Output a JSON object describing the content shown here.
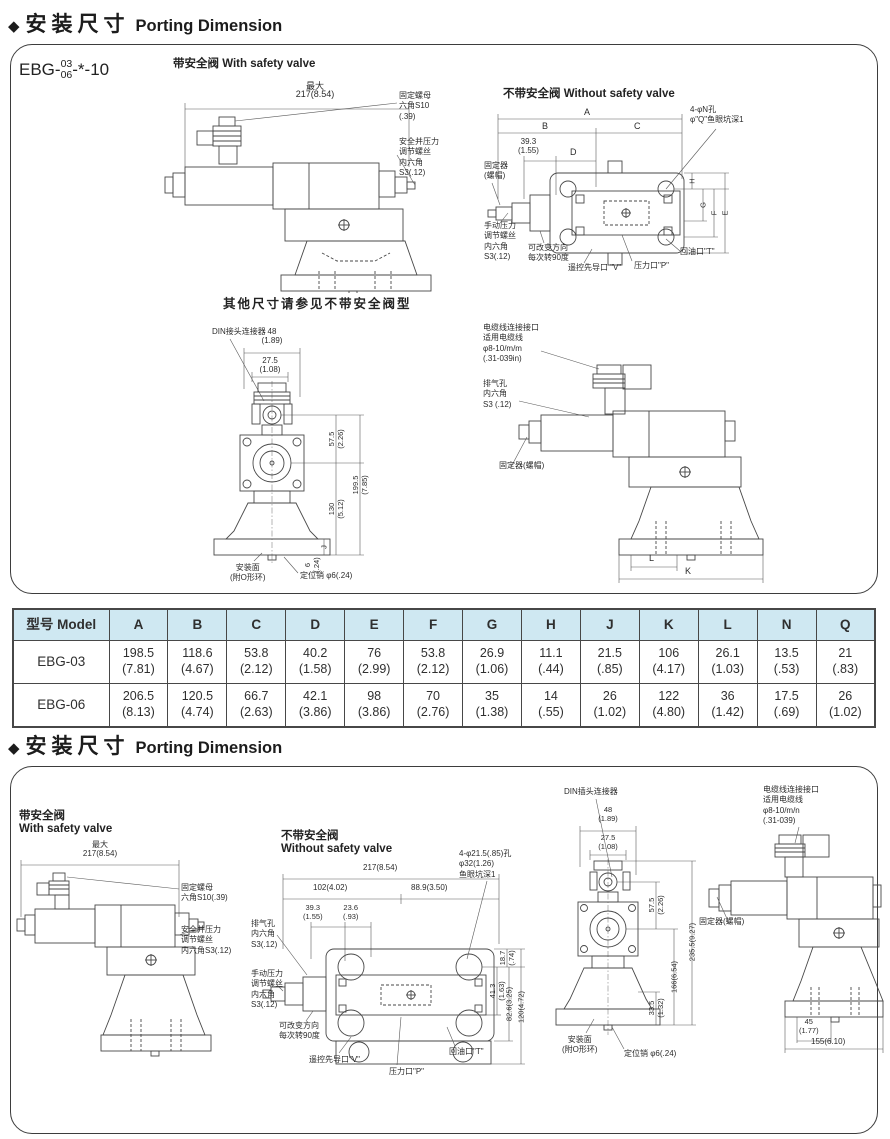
{
  "header1": {
    "diamond": "◆",
    "zh": "安装尺寸",
    "en": "Porting Dimension"
  },
  "header2": {
    "diamond": "◆",
    "zh": "安装尺寸",
    "en": "Porting Dimension"
  },
  "model": {
    "prefix": "EBG-",
    "top": "03",
    "bottom": "06",
    "suffix": "-*-10"
  },
  "p1": {
    "d1": {
      "title": "带安全阀   With safety valve",
      "dim_max": "最大",
      "dim_217": "217(8.54)",
      "lbl_nut": "固定螺母\n六角S10\n(.39)",
      "lbl_adj": "安全并压力\n调节螺丝\n内六角\nS3(.12)",
      "caption": "其他尺寸请参见不带安全阀型"
    },
    "d2": {
      "title": "不带安全阀   Without safety valve",
      "A": "A",
      "B": "B",
      "C": "C",
      "D": "D",
      "d393": "39.3\n(1.55)",
      "E": "E",
      "F": "F",
      "G": "G",
      "H": "H",
      "lbl_holes": "4-φN孔\nφ\"Q\"鱼眼坑深1",
      "lbl_fixer": "固定器\n(螺帽)",
      "lbl_manual": "手动压力\n调节螺丝\n内六角\nS3(.12)",
      "lbl_rotate": "可改变方向\n每次转90度",
      "lbl_pilot": "遥控先导口 \"V\"",
      "lbl_pressure": "压力口\"P\"",
      "lbl_return": "回油口\"T\""
    },
    "d3": {
      "lbl_din": "DIN接头连接器",
      "dim48": "48\n(1.89)",
      "dim275": "27.5\n(1.08)",
      "dim575": "57.5\n(2.26)",
      "dim1995": "199.5\n(7.85)",
      "dim130": "130\n(5.12)",
      "dimJ": "J",
      "dim6": "6\n(.24)",
      "lbl_mount": "安装面\n(附O形环)",
      "lbl_pin": "定位销 φ6(.24)"
    },
    "d4": {
      "lbl_cable": "电缆线连接接口\n适用电缆线\nφ8-10/m/m\n(.31-039in)",
      "lbl_vent": "排气孔\n内六角\nS3 (.12)",
      "lbl_fixer": "固定器(螺帽)",
      "dimL": "L",
      "dimK": "K"
    }
  },
  "table": {
    "headers": [
      "型号 Model",
      "A",
      "B",
      "C",
      "D",
      "E",
      "F",
      "G",
      "H",
      "J",
      "K",
      "L",
      "N",
      "Q"
    ],
    "rows": [
      {
        "model": "EBG-03",
        "cells": [
          "198.5\n(7.81)",
          "118.6\n(4.67)",
          "53.8\n(2.12)",
          "40.2\n(1.58)",
          "76\n(2.99)",
          "53.8\n(2.12)",
          "26.9\n(1.06)",
          "11.1\n(.44)",
          "21.5\n(.85)",
          "106\n(4.17)",
          "26.1\n(1.03)",
          "13.5\n(.53)",
          "21\n(.83)"
        ]
      },
      {
        "model": "EBG-06",
        "cells": [
          "206.5\n(8.13)",
          "120.5\n(4.74)",
          "66.7\n(2.63)",
          "42.1\n(3.86)",
          "98\n(3.86)",
          "70\n(2.76)",
          "35\n(1.38)",
          "14\n(.55)",
          "26\n(1.02)",
          "122\n(4.80)",
          "36\n(1.42)",
          "17.5\n(.69)",
          "26\n(1.02)"
        ]
      }
    ]
  },
  "p2": {
    "left_title": "带安全阀\nWith safety valve",
    "mid_title": "不带安全阀\nWithout safety valve",
    "d5": {
      "dim_max": "最大",
      "dim_217": "217(8.54)",
      "lbl_nut": "固定螺母\n六角S10(.39)",
      "lbl_adj": "安全并压力\n调节螺丝\n内六角S3(.12)"
    },
    "d6": {
      "dim217": "217(8.54)",
      "dim102": "102(4.02)",
      "dim889": "88.9(3.50)",
      "dim393": "39.3\n(1.55)",
      "dim236": "23.6\n(.93)",
      "lbl_holes": "4-φ21.5(.85)孔\nφ32(1.26)\n鱼眼坑深1",
      "dim187": "18.7\n(.74)",
      "dim413": "41.3\n(1.63)",
      "dim826": "82.6(3.25)",
      "dim120": "120(4.72)",
      "lbl_vent": "排气孔\n内六角\nS3(.12)",
      "lbl_manual": "手动压力\n调节螺丝\n内六角\nS3(.12)",
      "lbl_rotate": "可改变方向\n每次转90度",
      "lbl_pilot": "遥控先导口\"V\"",
      "lbl_pressure": "压力口\"P\"",
      "lbl_return": "回油口\"T\""
    },
    "d7": {
      "lbl_din": "DIN插头连接器",
      "dim48": "48\n(1.89)",
      "dim275": "27.5\n(1.08)",
      "dim575": "57.5\n(2.26)",
      "dim166": "166(6.54)",
      "dim2355": "235.5(9.27)",
      "dim335": "33.5\n(1.32)",
      "lbl_mount": "安装面\n(附O形环)",
      "lbl_pin": "定位销 φ6(.24)"
    },
    "d8": {
      "lbl_cable": "电缆线连接接口\n适用电缆线\nφ8-10/m/n\n(.31-039)",
      "lbl_fixer": "固定器(螺帽)",
      "dim45": "45\n(1.77)",
      "dim155": "155(6.10)"
    }
  }
}
